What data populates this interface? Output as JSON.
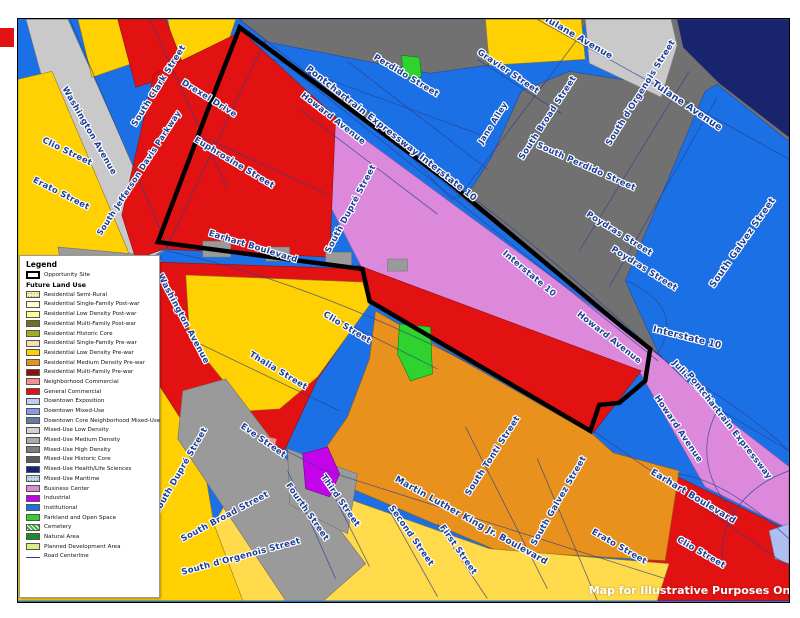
{
  "map_note": "Map for Illustrative Purposes Only",
  "legend": {
    "title": "Legend",
    "opportunity_site_label": "Opportunity Site",
    "section_header": "Future Land Use",
    "items": [
      {
        "id": "res-semi-rural",
        "label": "Residential Semi-Rural",
        "color": "#f2ecc0",
        "pattern": "speckle-tan"
      },
      {
        "id": "res-sf-postwar",
        "label": "Residential Single-Family Post-war",
        "color": "#ffffcc"
      },
      {
        "id": "res-ld-postwar",
        "label": "Residential Low Density Post-war",
        "color": "#ffff99"
      },
      {
        "id": "res-mf-postwar",
        "label": "Residential Multi-Family Post-war",
        "color": "#6e7022"
      },
      {
        "id": "res-historic-core",
        "label": "Residential Historic Core",
        "color": "#a8aa26"
      },
      {
        "id": "res-sf-prewar",
        "label": "Residential Single-Family Pre-war",
        "color": "#f5deb3"
      },
      {
        "id": "res-ld-prewar",
        "label": "Residential Low Density Pre-war",
        "color": "#ffd103"
      },
      {
        "id": "res-md-prewar",
        "label": "Residential Medium Density Pre-war",
        "color": "#e8921d"
      },
      {
        "id": "res-mf-prewar",
        "label": "Residential Multi-Family Pre-war",
        "color": "#8b1010"
      },
      {
        "id": "neighborhood-commercial",
        "label": "Neighborhood Commercial",
        "color": "#f4918e"
      },
      {
        "id": "general-commercial",
        "label": "General Commercial",
        "color": "#e31212"
      },
      {
        "id": "downtown-exposition",
        "label": "Downtown Exposition",
        "color": "#c3cdf2"
      },
      {
        "id": "downtown-mixed-use",
        "label": "Downtown Mixed-Use",
        "color": "#8899e8"
      },
      {
        "id": "downtown-core-nmu",
        "label": "Downtown Core Neighborhood Mixed-Use",
        "color": "#6479a8"
      },
      {
        "id": "mu-low",
        "label": "Mixed-Use Low Density",
        "color": "#d2d2d2"
      },
      {
        "id": "mu-med",
        "label": "Mixed-Use Medium Density",
        "color": "#ababab"
      },
      {
        "id": "mu-high",
        "label": "Mixed-Use High Density",
        "color": "#7d7d7d"
      },
      {
        "id": "mu-historic",
        "label": "Mixed-Use Historic Core",
        "color": "#5a5a5a"
      },
      {
        "id": "mu-health",
        "label": "Mixed-Use Health/Life Sciences",
        "color": "#18246e"
      },
      {
        "id": "mu-maritime",
        "label": "Mixed-Use Maritime",
        "color": "#c5d7ec",
        "pattern": "speckle-blue"
      },
      {
        "id": "business-center",
        "label": "Business Center",
        "color": "#dc89dc"
      },
      {
        "id": "industrial",
        "label": "Industrial",
        "color": "#c303e8"
      },
      {
        "id": "institutional",
        "label": "Institutional",
        "color": "#1a70e4"
      },
      {
        "id": "parkland",
        "label": "Parkland and Open Space",
        "color": "#2ed32e"
      },
      {
        "id": "cemetery",
        "label": "Cemetery",
        "color": "#3fae3f",
        "pattern": "hatch"
      },
      {
        "id": "natural-area",
        "label": "Natural Area",
        "color": "#1e8c1e"
      },
      {
        "id": "planned-dev",
        "label": "Planned Development Area",
        "color": "#d9ef83"
      }
    ],
    "road_centerline_label": "Road Centerline"
  },
  "street_labels": [
    {
      "id": "washington-avenue-1",
      "text": "Washington Avenue",
      "x": 71,
      "y": 112,
      "rot": 60
    },
    {
      "id": "south-clark-street",
      "text": "South Clark Street",
      "x": 141,
      "y": 67,
      "rot": -58
    },
    {
      "id": "drexel-drive",
      "text": "Drexel Drive",
      "x": 191,
      "y": 80,
      "rot": 32
    },
    {
      "id": "euphrosine-street",
      "text": "Euphrosine Street",
      "x": 216,
      "y": 144,
      "rot": 31
    },
    {
      "id": "clio-street-left",
      "text": "Clio Street",
      "x": 49,
      "y": 133,
      "rot": 26
    },
    {
      "id": "erato-street-left",
      "text": "Erato Street",
      "x": 43,
      "y": 175,
      "rot": 27
    },
    {
      "id": "south-jefferson-davis-parkway",
      "text": "South Jefferson Davis Parkway",
      "x": 121,
      "y": 154,
      "rot": -57,
      "size": 8
    },
    {
      "id": "earhart-boulevard-left",
      "text": "Earhart Boulevard",
      "x": 235,
      "y": 228,
      "rot": 17
    },
    {
      "id": "washington-avenue-2",
      "text": "Washington Avenue",
      "x": 165,
      "y": 300,
      "rot": 62
    },
    {
      "id": "south-dupre-street-mid",
      "text": "South Dupré Street",
      "x": 333,
      "y": 190,
      "rot": -62
    },
    {
      "id": "howard-avenue-top",
      "text": "Howard Avenue",
      "x": 315,
      "y": 100,
      "rot": 38
    },
    {
      "id": "pontchartrain-expressway-top",
      "text": "Pontchartrain Expressway   Interstate 10",
      "x": 373,
      "y": 115,
      "rot": 38,
      "size": 9
    },
    {
      "id": "perdido-street-top",
      "text": "Perdido Street",
      "x": 388,
      "y": 57,
      "rot": 31
    },
    {
      "id": "gravier-street",
      "text": "Gravier Street",
      "x": 490,
      "y": 53,
      "rot": 34
    },
    {
      "id": "jane-alley",
      "text": "Jane Alley",
      "x": 475,
      "y": 104,
      "rot": -58,
      "size": 8
    },
    {
      "id": "tulane-avenue-top",
      "text": "Tulane Avenue",
      "x": 560,
      "y": 19,
      "rot": 30,
      "size": 9
    },
    {
      "id": "tulane-avenue-right",
      "text": "Tulane Avenue",
      "x": 669,
      "y": 87,
      "rot": 34,
      "size": 9.5
    },
    {
      "id": "south-broad-street-topright",
      "text": "South Broad Street",
      "x": 530,
      "y": 99,
      "rot": -57
    },
    {
      "id": "south-dorgenois-street-topright",
      "text": "South d'Orgenois Street",
      "x": 623,
      "y": 74,
      "rot": -58
    },
    {
      "id": "south-perdido-street",
      "text": "South Perdido Street",
      "x": 568,
      "y": 148,
      "rot": 24
    },
    {
      "id": "poydras-street-1",
      "text": "Poydras Street",
      "x": 601,
      "y": 215,
      "rot": 32
    },
    {
      "id": "poydras-street-2",
      "text": "Poydras Street",
      "x": 626,
      "y": 250,
      "rot": 32
    },
    {
      "id": "south-galvez-street-topright",
      "text": "South Galvez Street",
      "x": 725,
      "y": 224,
      "rot": -55,
      "size": 9
    },
    {
      "id": "interstate-10-mid",
      "text": "Interstate 10",
      "x": 511,
      "y": 255,
      "rot": 40
    },
    {
      "id": "interstate-10-right",
      "text": "Interstate 10",
      "x": 669,
      "y": 319,
      "rot": 14,
      "size": 9
    },
    {
      "id": "julia-street",
      "text": "Julia Street",
      "x": 675,
      "y": 364,
      "rot": 47
    },
    {
      "id": "pontchartrain-expressway-right",
      "text": "Pontchartrain Expressway",
      "x": 711,
      "y": 407,
      "rot": 52
    },
    {
      "id": "howard-avenue-right1",
      "text": "Howard Avenue",
      "x": 591,
      "y": 319,
      "rot": 38
    },
    {
      "id": "howard-avenue-right2",
      "text": "Howard Avenue",
      "x": 660,
      "y": 410,
      "rot": 56
    },
    {
      "id": "earhart-boulevard-right",
      "text": "Earhart Boulevard",
      "x": 675,
      "y": 478,
      "rot": 31,
      "size": 9
    },
    {
      "id": "erato-street-right",
      "text": "Erato Street",
      "x": 601,
      "y": 528,
      "rot": 30
    },
    {
      "id": "clio-street-right",
      "text": "Clio Street",
      "x": 683,
      "y": 534,
      "rot": 30
    },
    {
      "id": "south-galvez-street-bottom",
      "text": "South Galvez Street",
      "x": 541,
      "y": 482,
      "rot": -60
    },
    {
      "id": "south-tonti-street",
      "text": "South Tonti Street",
      "x": 475,
      "y": 437,
      "rot": -57
    },
    {
      "id": "mlk-boulevard",
      "text": "Martin Luther King Jr. Boulevard",
      "x": 453,
      "y": 502,
      "rot": 29,
      "size": 9
    },
    {
      "id": "first-street",
      "text": "First Street",
      "x": 440,
      "y": 531,
      "rot": 55
    },
    {
      "id": "second-street",
      "text": "Second Street",
      "x": 393,
      "y": 517,
      "rot": 55
    },
    {
      "id": "third-street",
      "text": "Third Street",
      "x": 322,
      "y": 482,
      "rot": 55
    },
    {
      "id": "fourth-street",
      "text": "Fourth Street",
      "x": 289,
      "y": 493,
      "rot": 55
    },
    {
      "id": "eve-street",
      "text": "Eve Street",
      "x": 245,
      "y": 422,
      "rot": 35
    },
    {
      "id": "south-broad-street-bottom",
      "text": "South Broad Street",
      "x": 207,
      "y": 498,
      "rot": -28
    },
    {
      "id": "south-dorgenois-street-bottom",
      "text": "South d'Orgenois Street",
      "x": 223,
      "y": 538,
      "rot": -15
    },
    {
      "id": "south-dupre-street-bottom",
      "text": "South Dupré Street",
      "x": 163,
      "y": 452,
      "rot": -60
    },
    {
      "id": "thalia-street",
      "text": "Thalia Street",
      "x": 260,
      "y": 352,
      "rot": 31
    },
    {
      "id": "clio-street-mid",
      "text": "Clio Street",
      "x": 329,
      "y": 309,
      "rot": 31
    }
  ],
  "colors": {
    "institutional_blue": "#1a70e4",
    "mixed_use_high_gray": "#717171",
    "health_sciences_navy": "#18246e",
    "business_center_orchid": "#dc89dc",
    "general_commercial_red": "#e31212",
    "low_density_gold": "#ffd103",
    "single_family_yellow": "#ffda4a",
    "medium_density_orange": "#e8921d",
    "mixed_low_lightgray": "#c9c9c9",
    "mixed_med_gray": "#9a9a9a",
    "parkland_green": "#2ed32e",
    "industrial_magenta": "#c303e8",
    "label_blue": "#1d3e96",
    "centerline_navy": "#2b3f8f"
  }
}
